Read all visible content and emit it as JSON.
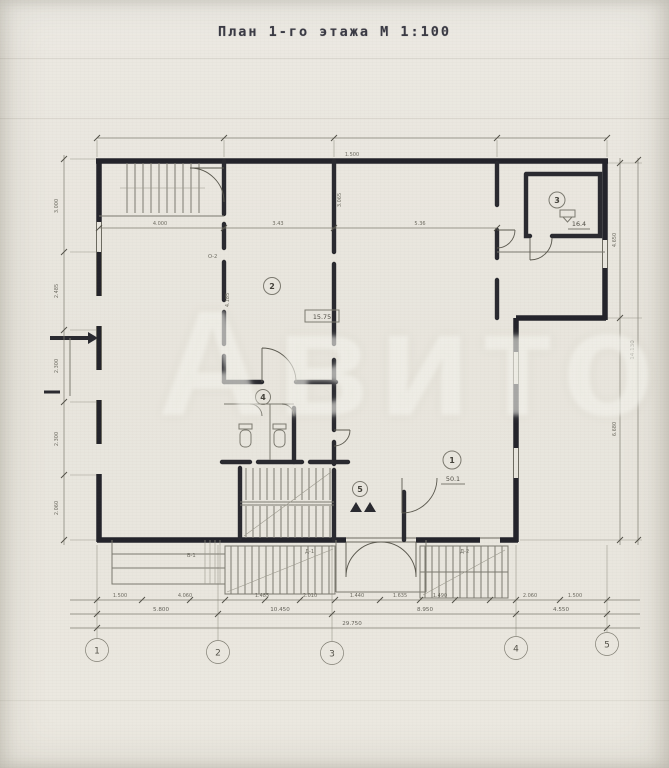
{
  "title": "План 1-го этажа М 1:100",
  "watermark": "Авито",
  "axis_circles": [
    "1",
    "2",
    "3",
    "4",
    "5"
  ],
  "rooms": {
    "main": {
      "number": "1",
      "area": "50.1"
    },
    "hall": {
      "number": "2",
      "area": "15.75"
    },
    "annex": {
      "number": "3",
      "area": "16.4"
    },
    "lobby": {
      "number": "4"
    },
    "stair": {
      "number": "5"
    }
  },
  "dims": {
    "inner": [
      "4.000",
      "3.43",
      "5.36"
    ],
    "top": "1.500",
    "wall_vertical": [
      "3.065",
      "4.185"
    ],
    "row1": [
      "1.500",
      "4.060",
      "1.485",
      "2.010",
      "1.440",
      "1.635",
      "1.490",
      "2.060",
      "1.500"
    ],
    "row2": [
      "5.800",
      "10.450",
      "8.950",
      "4.550"
    ],
    "total": "29.750",
    "left": [
      "3.000",
      "2.485",
      "2.300",
      "2.300",
      "2.060"
    ],
    "right": [
      "4.650",
      "6.680"
    ],
    "right_total": "14.130"
  },
  "labels": {
    "w1": "В-1",
    "d1": "Д-1",
    "d2": "Д-2",
    "o2": "О-2"
  }
}
